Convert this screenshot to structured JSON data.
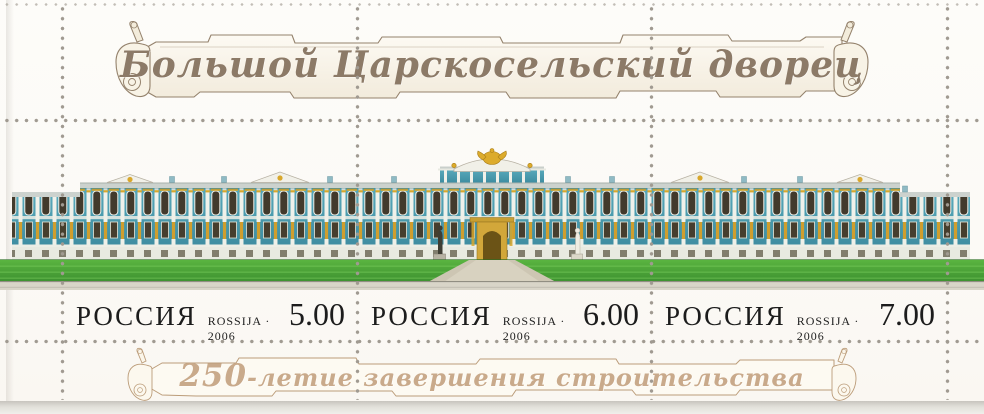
{
  "sheet": {
    "title": "Большой Царскосельский дворец",
    "anniversary": {
      "number": "250",
      "suffix": "-летие завершения строительства"
    },
    "stamps": [
      {
        "country": "РОССИЯ",
        "issue": "ROSSIJA · 2006",
        "value": "5.00"
      },
      {
        "country": "РОССИЯ",
        "issue": "ROSSIJA · 2006",
        "value": "6.00"
      },
      {
        "country": "РОССИЯ",
        "issue": "ROSSIJA · 2006",
        "value": "7.00"
      }
    ],
    "illustration": "catherine-palace-facade-panorama",
    "palette": {
      "facade_teal": "#4397ac",
      "ornament_gold": "#d8a72c",
      "lawn_green": "#4aa63a",
      "title_script_brown": "#8c7a67",
      "banner_script_tan": "#c9aa8b",
      "perforation_dot": "#a09a91",
      "caption_black": "#1c1c1c"
    }
  }
}
